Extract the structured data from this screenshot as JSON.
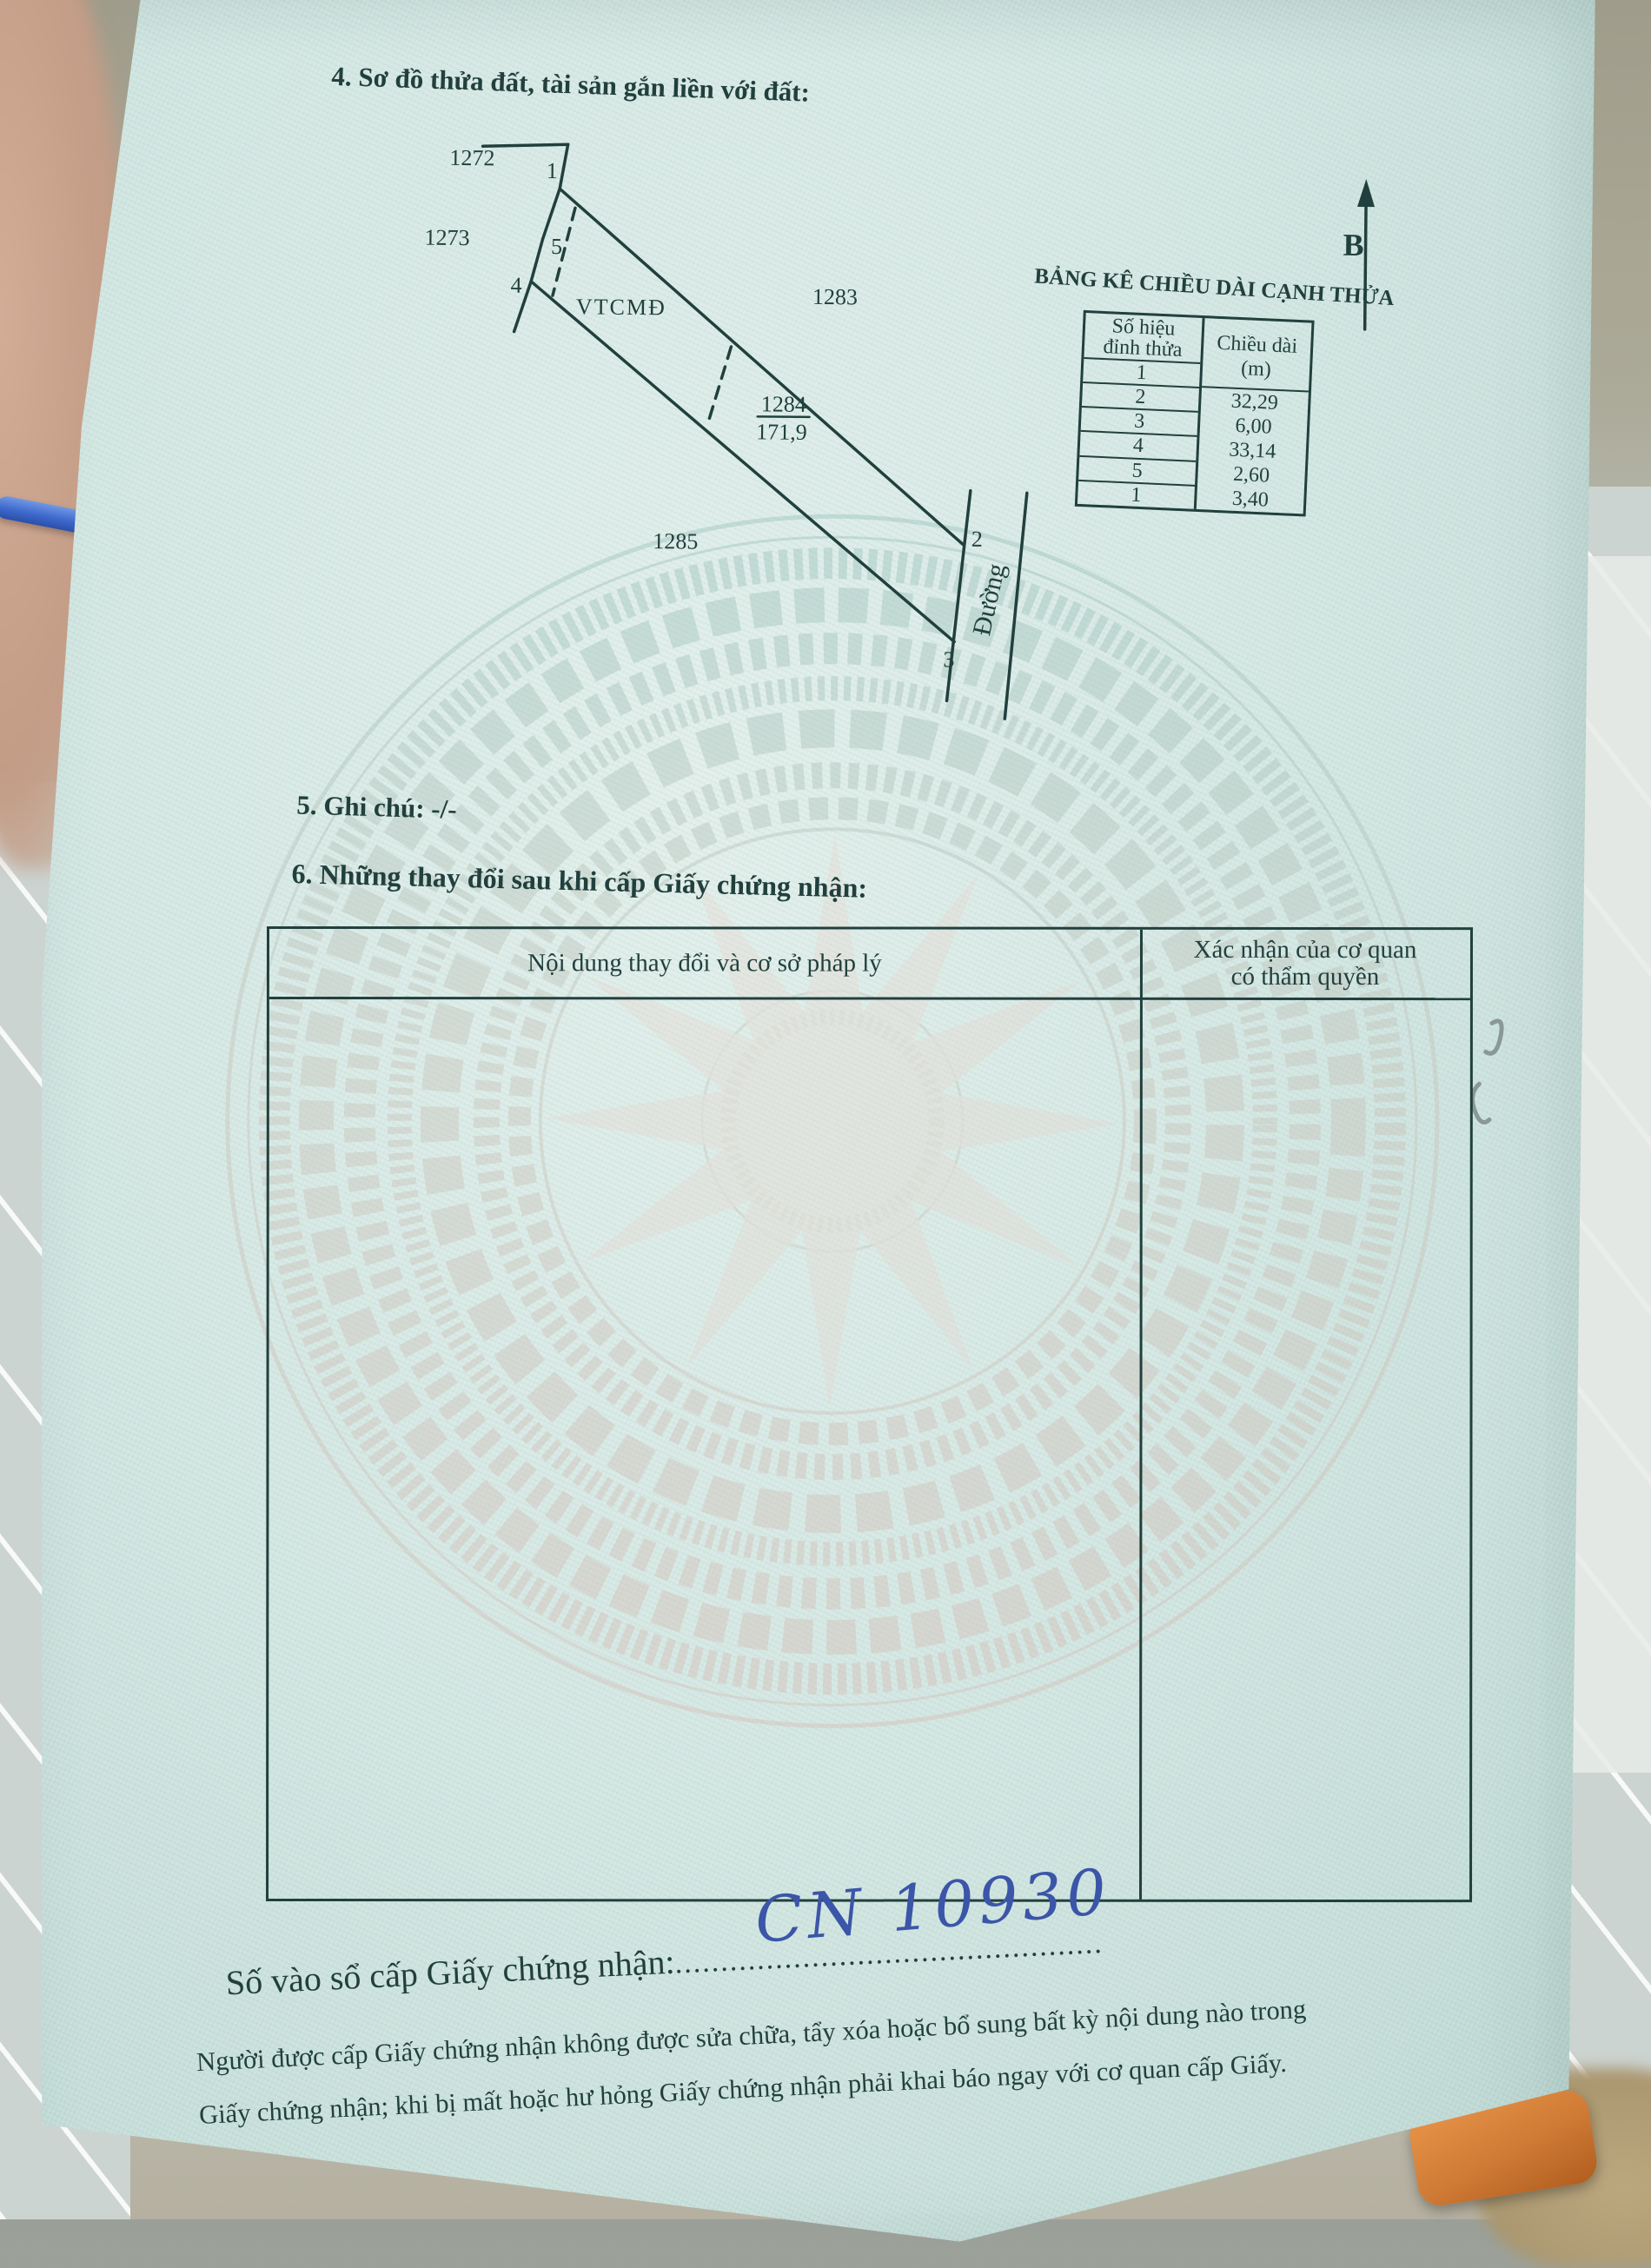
{
  "document": {
    "section4_title": "4. Sơ đồ thửa đất, tài sản gắn liền với đất:",
    "section5_title": "5. Ghi chú: -/-",
    "section6_title": "6. Những thay đổi sau khi cấp Giấy chứng nhận:"
  },
  "diagram": {
    "north_label": "B",
    "zone_label": "VTCMĐ",
    "road_label": "Đường",
    "parcels": {
      "top": "1272",
      "left": "1273",
      "right": "1283",
      "bottom": "1285",
      "subject_number": "1284",
      "subject_area": "171,9"
    },
    "vertices": {
      "v1": "1",
      "v2": "2",
      "v3": "3",
      "v4": "4",
      "v5": "5"
    }
  },
  "edge_table": {
    "title": "BẢNG KÊ CHIỀU DÀI CẠNH THỬA",
    "col1_header_line1": "Số hiệu",
    "col1_header_line2": "đỉnh thửa",
    "col2_header_line1": "Chiều dài",
    "col2_header_line2": "(m)",
    "vertex_rows": [
      "1",
      "2",
      "3",
      "4",
      "5",
      "1"
    ],
    "length_rows": [
      "32,29",
      "6,00",
      "33,14",
      "2,60",
      "3,40"
    ]
  },
  "changes_table": {
    "col1_header": "Nội dung thay đổi và cơ sở pháp lý",
    "col2_header_line1": "Xác nhận của cơ quan",
    "col2_header_line2": "có thẩm quyền"
  },
  "footer": {
    "registry_label": "Số vào sổ cấp Giấy chứng nhận:",
    "registry_dots": "...............................................",
    "registry_number": "CN 10930",
    "note_line1": "Người được cấp Giấy chứng nhận không được sửa chữa, tẩy xóa hoặc bổ sung bất kỳ nội dung nào trong",
    "note_line2": "Giấy chứng nhận; khi bị mất hoặc hư hỏng Giấy chứng nhận phải khai báo ngay với cơ quan cấp Giấy."
  },
  "colors": {
    "ink": "#21403d",
    "paper": "#d4e7e3",
    "handwriting_blue": "#3b55a8",
    "watermark_teal": "#8fbdb6",
    "watermark_pink": "#d8b9b1"
  }
}
